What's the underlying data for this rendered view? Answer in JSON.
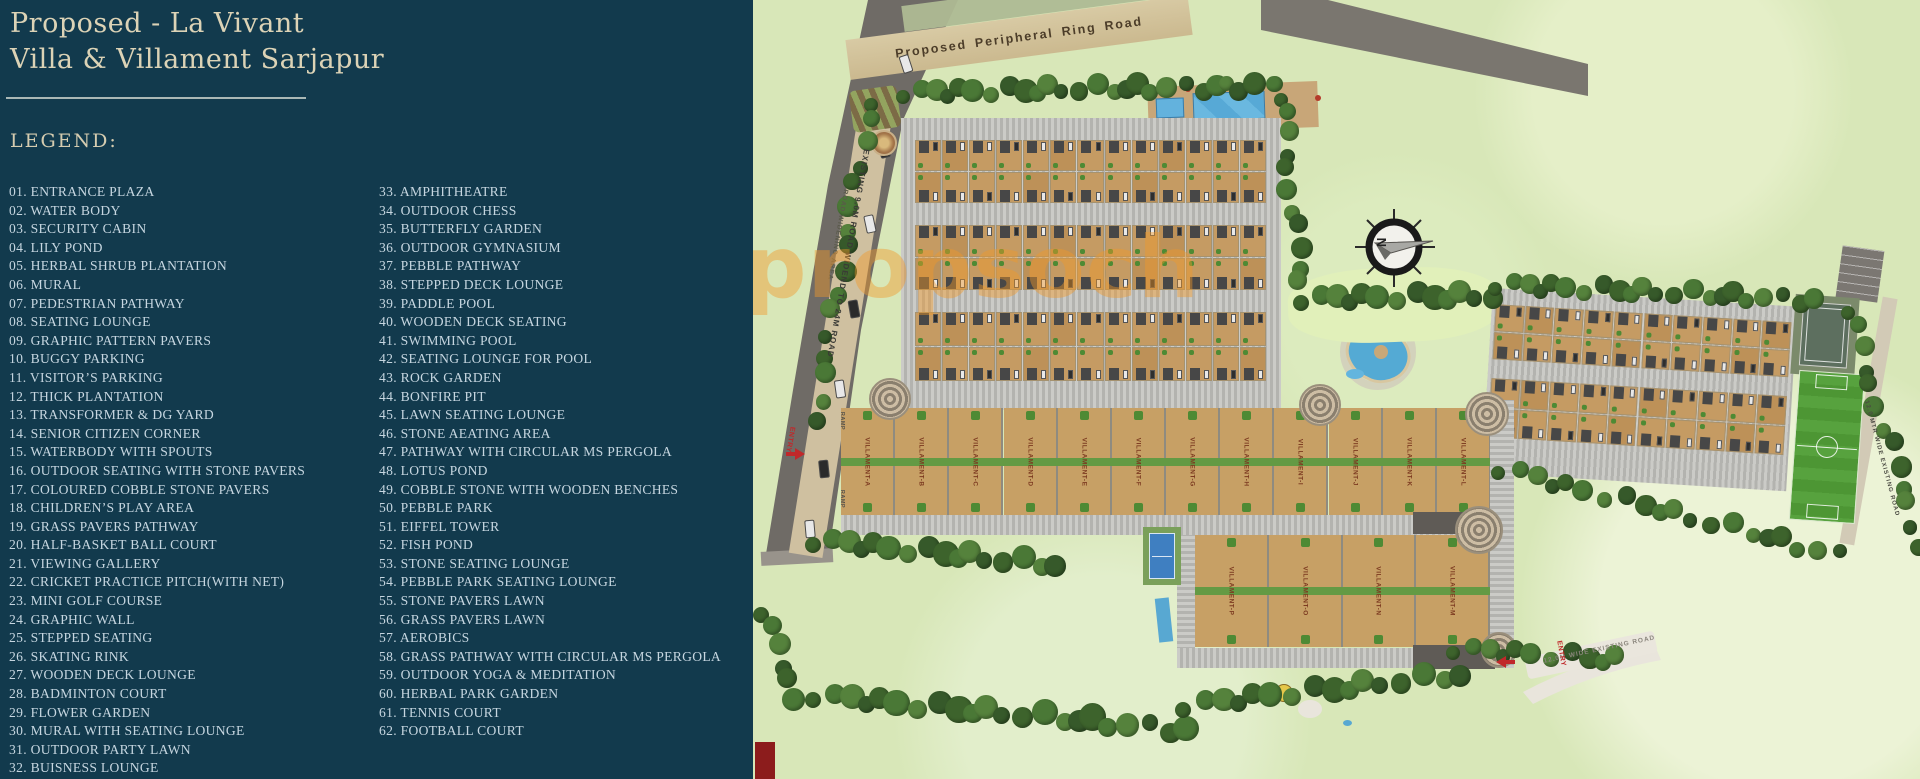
{
  "panel": {
    "title_lines": [
      "Proposed - La Vivant",
      "Villa & Villament Sarjapur"
    ],
    "legend_heading": "LEGEND:",
    "legend_col1": [
      "01. ENTRANCE PLAZA",
      "02. WATER BODY",
      "03. SECURITY CABIN",
      "04. LILY POND",
      "05. HERBAL SHRUB PLANTATION",
      "06. MURAL",
      "07. PEDESTRIAN PATHWAY",
      "08. SEATING LOUNGE",
      "09. GRAPHIC PATTERN PAVERS",
      "10. BUGGY PARKING",
      "11. VISITOR’S PARKING",
      "12. THICK PLANTATION",
      "13. TRANSFORMER & DG YARD",
      "14. SENIOR CITIZEN CORNER",
      "15. WATERBODY WITH SPOUTS",
      "16. OUTDOOR SEATING WITH STONE PAVERS",
      "17. COLOURED COBBLE STONE PAVERS",
      "18. CHILDREN’S PLAY AREA",
      "19. GRASS PAVERS PATHWAY",
      "20. HALF-BASKET BALL COURT",
      "21. VIEWING GALLERY",
      "22. CRICKET PRACTICE PITCH(WITH NET)",
      "23. MINI GOLF COURSE",
      "24. GRAPHIC WALL",
      "25. STEPPED SEATING",
      "26. SKATING RINK",
      "27. WOODEN DECK LOUNGE",
      "28. BADMINTON COURT",
      "29. FLOWER GARDEN",
      "30. MURAL WITH SEATING LOUNGE",
      "31. OUTDOOR PARTY LAWN",
      "32. BUISNESS LOUNGE"
    ],
    "legend_col2": [
      "33. AMPHITHEATRE",
      "34. OUTDOOR CHESS",
      "35. BUTTERFLY GARDEN",
      "36. OUTDOOR GYMNASIUM",
      "37. PEBBLE PATHWAY",
      "38. STEPPED DECK LOUNGE",
      "39. PADDLE POOL",
      "40. WOODEN DECK SEATING",
      "41. SWIMMING POOL",
      "42. SEATING LOUNGE FOR POOL",
      "43. ROCK GARDEN",
      "44. BONFIRE PIT",
      "45. LAWN SEATING LOUNGE",
      "46. STONE AEATING AREA",
      "47. PATHWAY WITH CIRCULAR MS PERGOLA",
      "48. LOTUS POND",
      "49. COBBLE STONE WITH WOODEN BENCHES",
      "50. PEBBLE PARK",
      "51. EIFFEL TOWER",
      "52. FISH POND",
      "53. STONE SEATING LOUNGE",
      "54. PEBBLE PARK SEATING LOUNGE",
      "55. STONE PAVERS LAWN",
      "56. GRASS PAVERS LAWN",
      "57. AEROBICS",
      "58. GRASS PATHWAY WITH CIRCULAR MS PERGOLA",
      "59. OUTDOOR YOGA & MEDITATION",
      "60. HERBAL PARK GARDEN",
      "61. TENNIS COURT",
      "62. FOOTBALL COURT"
    ]
  },
  "map": {
    "watermark": "propsoch",
    "compass_n": "N",
    "labels": {
      "ring_road": "Proposed Peripheral Ring Road",
      "left_road": "EXISTING 9.0M ROAD WIDEND TO 24M ROAD",
      "road_widening": "ROAD WIDENING AREA",
      "bottom_road": "12.0M WIDE EXISTING ROAD",
      "right_road": "12.0 MTR WIDE EXISTING ROAD",
      "entry": "ENTRY",
      "ramp": "RAMP"
    },
    "villaments_top": [
      "VILLAMENT-A",
      "VILLAMENT-B",
      "VILLAMENT-C",
      "VILLAMENT-D",
      "VILLAMENT-E",
      "VILLAMENT-F",
      "VILLAMENT-G",
      "VILLAMENT-H",
      "VILLAMENT-I",
      "VILLAMENT-J",
      "VILLAMENT-K",
      "VILLAMENT-L"
    ],
    "villaments_bottom": [
      "VILLAMENT-P",
      "VILLAMENT-O",
      "VILLAMENT-N",
      "VILLAMENT-M"
    ]
  },
  "colors": {
    "panel_bg": "#123a4d",
    "title_text": "#dcd3b6",
    "legend_text": "#c6d6e0",
    "watermark": "#f09a28",
    "grass": "#d8e7b8",
    "road": "#6f6b66",
    "plot_tan": "#c59b63",
    "pool_blue": "#54aad4",
    "field_green": "#55a03c",
    "entry_red": "#c0282a"
  }
}
